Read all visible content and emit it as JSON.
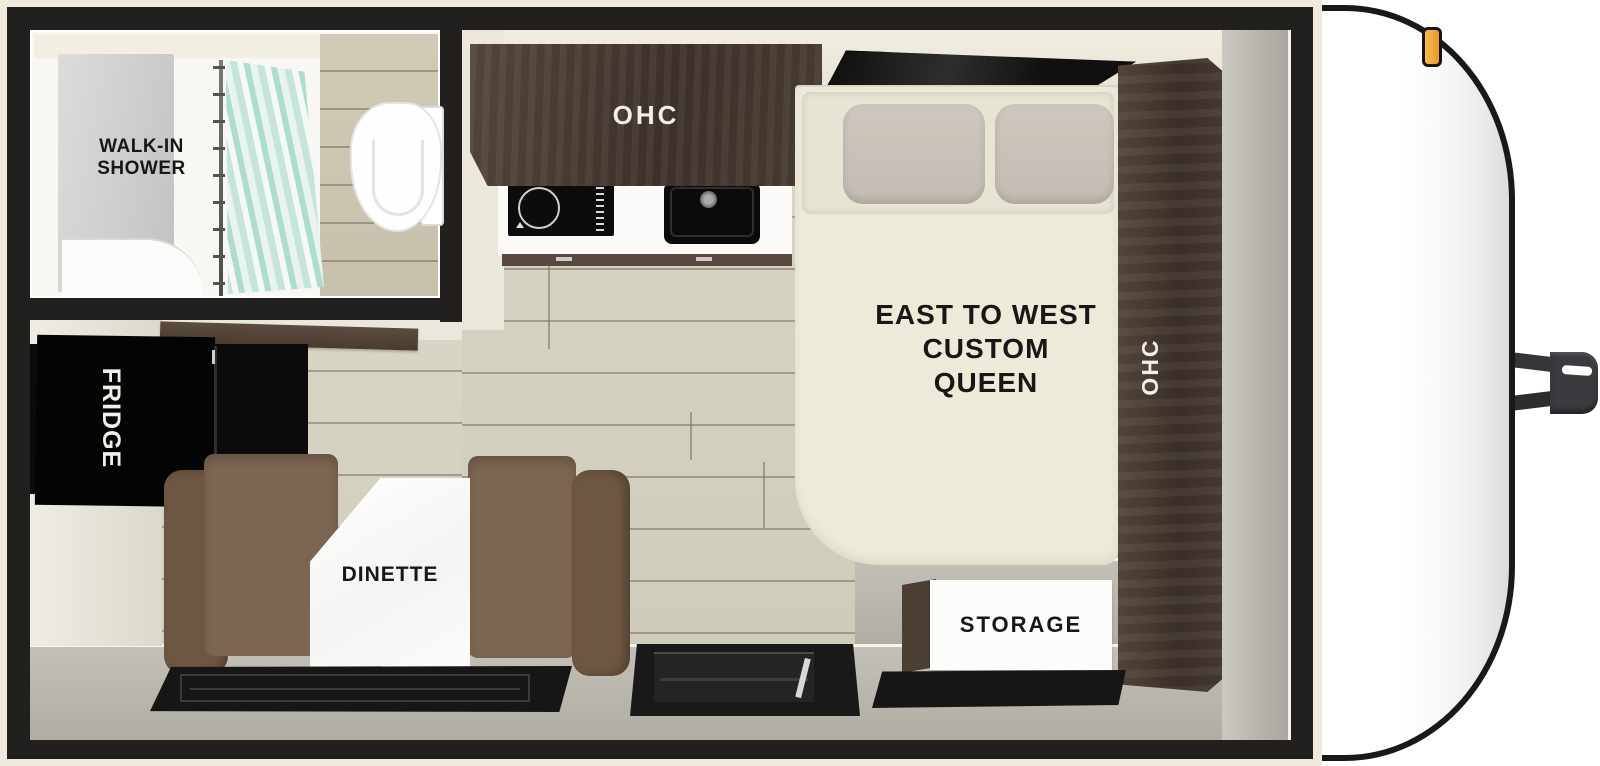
{
  "floorplan": {
    "bathroom": {
      "label_line1": "WALK-IN",
      "label_line2": "SHOWER"
    },
    "kitchen": {
      "overhead_cabinet_label": "OHC"
    },
    "bedroom": {
      "bed_label_line1": "EAST TO WEST",
      "bed_label_line2": "CUSTOM",
      "bed_label_line3": "QUEEN",
      "wardrobe_label": "OHC",
      "storage_label": "STORAGE"
    },
    "dinette": {
      "label": "DINETTE"
    },
    "galley": {
      "fridge_label": "FRIDGE"
    },
    "colors": {
      "wall_black": "#21201e",
      "exterior_trim_cream": "#efeadd",
      "cabinet_wood_brown": "#46392f",
      "floor_wood_beige": "#d6d2c2",
      "floor_gray": "#b7b5ac",
      "mattress_cream": "#ecead9",
      "pillow_gray": "#c8c2b9",
      "bench_brown": "#7d6652",
      "appliance_black": "#0d0d0d",
      "shower_curtain_teal": "#cde7dd",
      "marker_light_amber": "#f0a93c",
      "trailer_body_white": "#ffffff"
    }
  }
}
